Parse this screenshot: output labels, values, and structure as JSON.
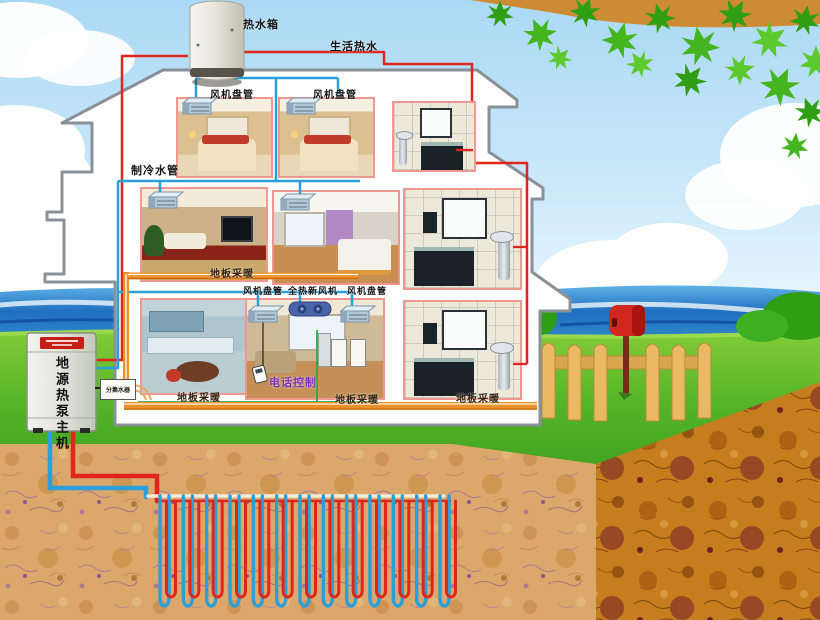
{
  "labels": {
    "tank": "热水箱",
    "domestic_hot_water": "生活热水",
    "fan_coil_top_left": "风机盘管",
    "fan_coil_top_right": "风机盘管",
    "cooling_water_pipe": "制冷水管",
    "floor_heating_mid": "地板采暖",
    "fan_coil_ground_left": "风机盘管",
    "fresh_air_unit": "全热新风机",
    "fan_coil_ground_right": "风机盘管",
    "phone_control": "电话控制",
    "floor_heating_kitchen": "地板采暖",
    "floor_heating_living": "地板采暖",
    "floor_heating_bath": "地板采暖",
    "heat_pump_main_unit": "地源热泵主机",
    "manifold": "分集水器"
  },
  "colors": {
    "hot_water_pipe": "#e0251c",
    "chilled_water_pipe": "#2a9fd8",
    "floor_heating_pipe": "#ea8f2a",
    "control_line": "#2ea84a",
    "phone_control_text": "#7b2fbf"
  },
  "underground": {
    "loop_count": 13,
    "loop_top_y": 496,
    "loop_bottom_y": 606
  }
}
